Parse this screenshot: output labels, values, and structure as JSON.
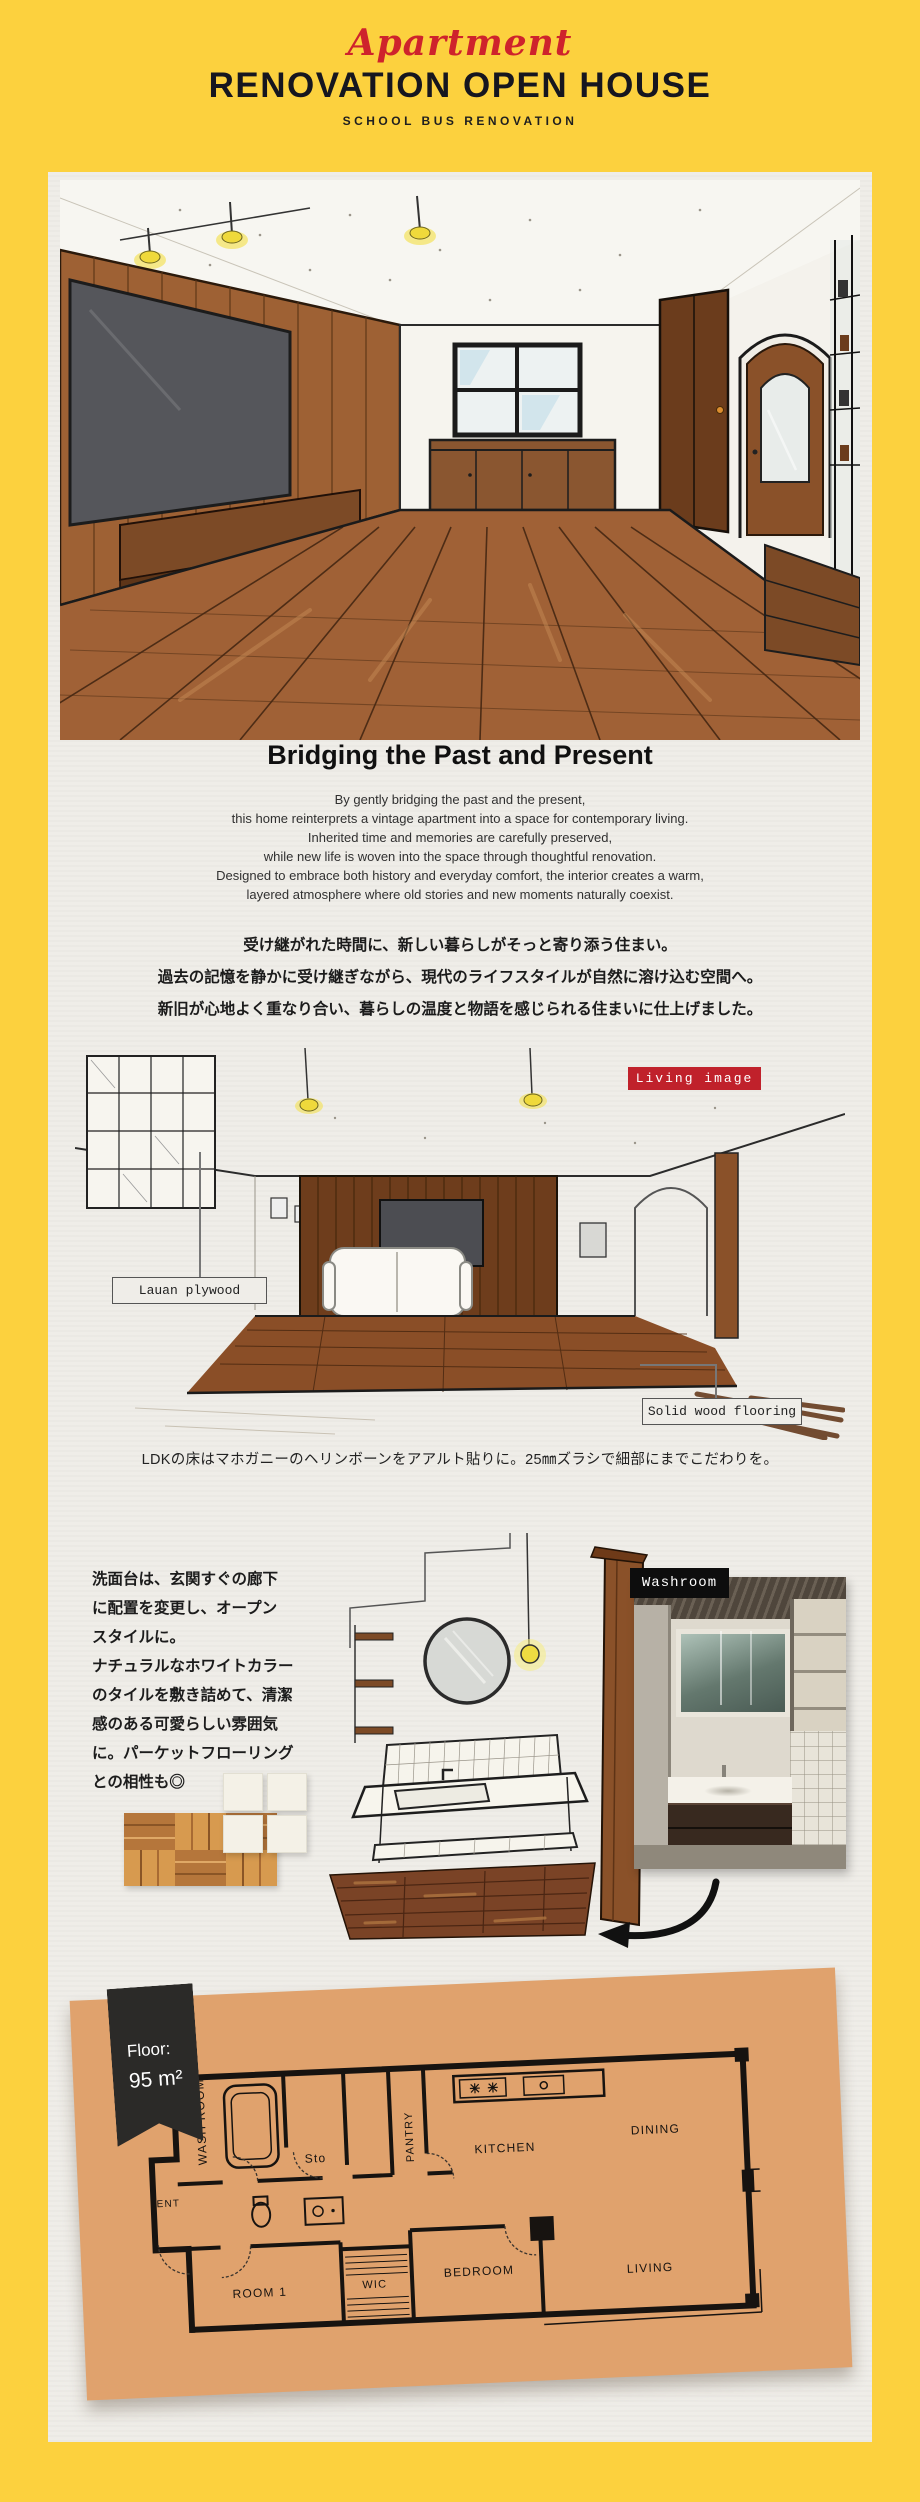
{
  "theme": {
    "frame_yellow": "#FCD13E",
    "paper": "#EFEDE8",
    "accent_red": "#C0212B",
    "script_red": "#CE232C",
    "ink": "#16161F",
    "plan_paper": "#E0A26D",
    "tag_black": "#0d0d0d"
  },
  "header": {
    "script_word": "Apartment",
    "title": "RENOVATION OPEN HOUSE",
    "subtitle": "SCHOOL BUS RENOVATION"
  },
  "intro": {
    "heading": "Bridging the Past and Present",
    "lines_en": [
      "By gently bridging the past and the present,",
      "this home reinterprets a vintage apartment into a space for contemporary living.",
      "Inherited time and memories are carefully preserved,",
      "while new life is woven into the space through thoughtful renovation.",
      "Designed to embrace both history and everyday comfort, the interior creates a warm,",
      "layered atmosphere where old stories and new moments naturally coexist."
    ],
    "lines_ja": [
      "受け継がれた時間に、新しい暮らしがそっと寄り添う住まい。",
      "過去の記憶を静かに受け継ぎながら、現代のライフスタイルが自然に溶け込む空間へ。",
      "新旧が心地よく重なり合い、暮らしの温度と物語を感じられる住まいに仕上げました。"
    ]
  },
  "living": {
    "tag": "Living image",
    "label_left": "Lauan plywood",
    "label_right": "Solid wood flooring",
    "caption": "LDKの床はマホガニーのヘリンボーンをアアルト貼りに。25㎜ズラシで細部にまでこだわりを。"
  },
  "washroom": {
    "tag": "Washroom",
    "text_lines": [
      "洗面台は、玄関すぐの廊下",
      "に配置を変更し、オープン",
      "スタイルに。",
      "ナチュラルなホワイトカラー",
      "のタイルを敷き詰めて、清潔",
      "感のある可愛らしい雰囲気",
      "に。パーケットフローリング",
      "との相性も◎"
    ]
  },
  "floorplan": {
    "badge_label": "Floor:",
    "badge_value": "95 m²",
    "rooms": [
      "WASH ROOM",
      "Sto",
      "PANTRY",
      "KITCHEN",
      "DINING",
      "ENT",
      "ROOM 1",
      "WIC",
      "BEDROOM",
      "LIVING"
    ]
  }
}
